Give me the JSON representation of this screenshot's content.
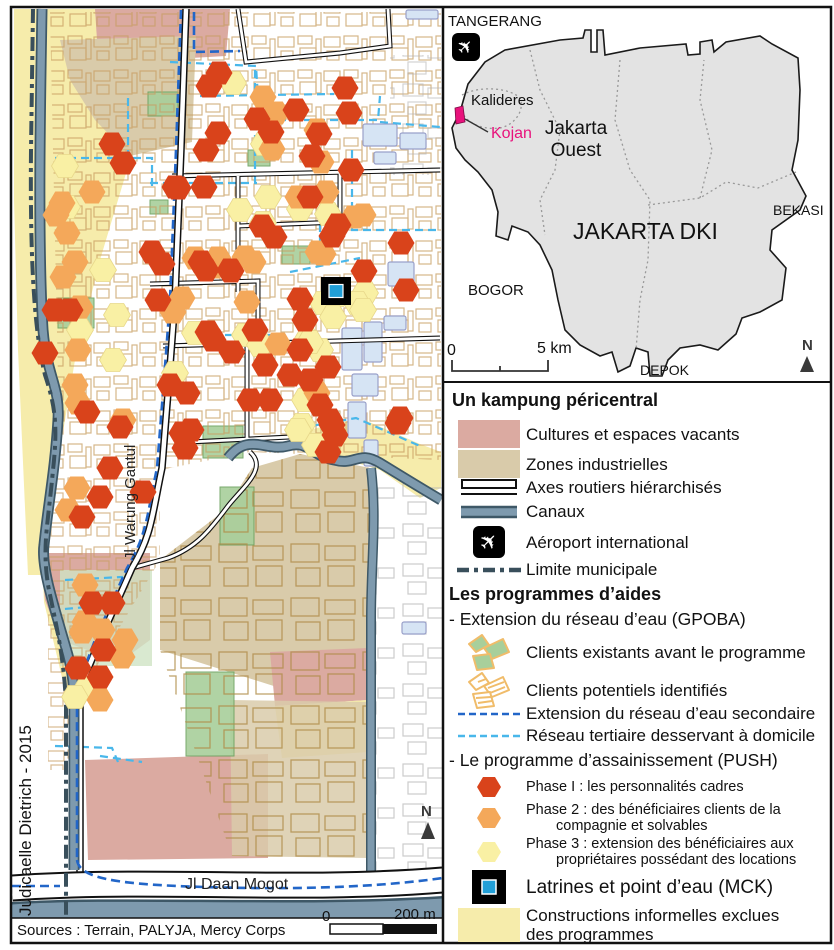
{
  "credit": "Judicaelle Dietrich - 2015",
  "sources": "Sources : Terrain, PALYJA, Mercy Corps",
  "map": {
    "road_label_vertical": "Jl Warung Gantul",
    "road_label_bottom": "Jl Daan Mogot",
    "north_label": "N",
    "scalebar": {
      "zero": "0",
      "end": "200 m"
    },
    "markers": {
      "phase1": [
        [
          219,
          73
        ],
        [
          209,
          86
        ],
        [
          296,
          110
        ],
        [
          218,
          133
        ],
        [
          206,
          150
        ],
        [
          257,
          119
        ],
        [
          271,
          132
        ],
        [
          345,
          88
        ],
        [
          349,
          113
        ],
        [
          319,
          134
        ],
        [
          312,
          156
        ],
        [
          175,
          187
        ],
        [
          204,
          187
        ],
        [
          123,
          163
        ],
        [
          310,
          197
        ],
        [
          262,
          226
        ],
        [
          274,
          237
        ],
        [
          332,
          236
        ],
        [
          338,
          225
        ],
        [
          401,
          243
        ],
        [
          152,
          252
        ],
        [
          201,
          262
        ],
        [
          231,
          271
        ],
        [
          162,
          264
        ],
        [
          300,
          299
        ],
        [
          364,
          271
        ],
        [
          406,
          290
        ],
        [
          351,
          170
        ],
        [
          112,
          144
        ],
        [
          178,
          188
        ],
        [
          55,
          310
        ],
        [
          70,
          310
        ],
        [
          158,
          300
        ],
        [
          120,
          427
        ],
        [
          45,
          353
        ],
        [
          87,
          412
        ],
        [
          143,
          492
        ],
        [
          110,
          468
        ],
        [
          100,
          497
        ],
        [
          82,
          517
        ],
        [
          208,
          332
        ],
        [
          213,
          340
        ],
        [
          170,
          385
        ],
        [
          187,
          393
        ],
        [
          182,
          433
        ],
        [
          185,
          448
        ],
        [
          230,
          270
        ],
        [
          92,
          603
        ],
        [
          112,
          603
        ],
        [
          103,
          650
        ],
        [
          78,
          668
        ],
        [
          100,
          677
        ],
        [
          305,
          320
        ],
        [
          328,
          367
        ],
        [
          332,
          425
        ],
        [
          398,
          423
        ],
        [
          328,
          452
        ],
        [
          191,
          430
        ],
        [
          206,
          270
        ],
        [
          290,
          375
        ],
        [
          310,
          380
        ],
        [
          330,
          420
        ],
        [
          335,
          435
        ],
        [
          320,
          405
        ],
        [
          265,
          365
        ],
        [
          250,
          400
        ],
        [
          270,
          400
        ],
        [
          300,
          350
        ],
        [
          255,
          330
        ],
        [
          232,
          352
        ],
        [
          400,
          418
        ]
      ],
      "phase2": [
        [
          263,
          97
        ],
        [
          276,
          113
        ],
        [
          317,
          130
        ],
        [
          321,
          162
        ],
        [
          272,
          149
        ],
        [
          298,
          197
        ],
        [
          326,
          192
        ],
        [
          354,
          217
        ],
        [
          363,
          215
        ],
        [
          318,
          252
        ],
        [
          245,
          257
        ],
        [
          195,
          258
        ],
        [
          253,
          262
        ],
        [
          247,
          302
        ],
        [
          323,
          254
        ],
        [
          67,
          233
        ],
        [
          75,
          262
        ],
        [
          63,
          277
        ],
        [
          80,
          307
        ],
        [
          182,
          298
        ],
        [
          173,
          312
        ],
        [
          78,
          350
        ],
        [
          75,
          385
        ],
        [
          78,
          403
        ],
        [
          123,
          420
        ],
        [
          68,
          510
        ],
        [
          77,
          488
        ],
        [
          213,
          267
        ],
        [
          218,
          258
        ],
        [
          85,
          585
        ],
        [
          85,
          622
        ],
        [
          82,
          632
        ],
        [
          102,
          630
        ],
        [
          125,
          640
        ],
        [
          122,
          657
        ],
        [
          100,
          700
        ],
        [
          92,
          192
        ],
        [
          62,
          203
        ],
        [
          56,
          215
        ],
        [
          317,
          393
        ],
        [
          278,
          344
        ]
      ],
      "phase3": [
        [
          233,
          83
        ],
        [
          264,
          144
        ],
        [
          268,
          197
        ],
        [
          300,
          209
        ],
        [
          328,
          214
        ],
        [
          263,
          223
        ],
        [
          337,
          295
        ],
        [
          365,
          293
        ],
        [
          103,
          270
        ],
        [
          117,
          315
        ],
        [
          80,
          330
        ],
        [
          113,
          360
        ],
        [
          175,
          373
        ],
        [
          87,
          688
        ],
        [
          75,
          697
        ],
        [
          65,
          166
        ],
        [
          67,
          207
        ],
        [
          323,
          303
        ],
        [
          333,
          317
        ],
        [
          307,
          340
        ],
        [
          320,
          350
        ],
        [
          357,
          303
        ],
        [
          363,
          310
        ],
        [
          302,
          425
        ],
        [
          315,
          445
        ],
        [
          195,
          333
        ],
        [
          240,
          210
        ],
        [
          245,
          335
        ],
        [
          260,
          345
        ],
        [
          305,
          400
        ],
        [
          298,
          430
        ],
        [
          310,
          342
        ]
      ],
      "mck": [
        336,
        291
      ]
    }
  },
  "inset": {
    "labels": {
      "tangerang": "TANGERANG",
      "kalideres": "Kalideres",
      "kojan": "Kojan",
      "jakarta_ouest": "Jakarta Ouest",
      "jakarta_dki": "JAKARTA DKI",
      "bekasi": "BEKASI",
      "bogor": "BOGOR",
      "depok": "DEPOK"
    },
    "scalebar": {
      "zero": "0",
      "end": "5 km"
    },
    "north_label": "N"
  },
  "legend": {
    "section1_title": "Un kampung péricentral",
    "items1": [
      {
        "label": "Cultures et espaces vacants"
      },
      {
        "label": "Zones industrielles"
      },
      {
        "label": "Axes routiers hiérarchisés"
      },
      {
        "label": "Canaux"
      },
      {
        "label": "Aéroport international"
      },
      {
        "label": "Limite municipale"
      }
    ],
    "section2_title": "Les programmes d’aides",
    "gpoba_title": "- Extension du réseau d’eau (GPOBA)",
    "gpoba_items": [
      {
        "label": "Clients existants avant le programme"
      },
      {
        "label": "Clients potentiels identifiés"
      },
      {
        "label": "Extension du réseau d’eau secondaire"
      },
      {
        "label": "Réseau tertiaire desservant à domicile"
      }
    ],
    "push_title": "- Le programme d’assainissement (PUSH)",
    "push_items": [
      {
        "line1": "Phase I : les personnalités cadres",
        "line2": ""
      },
      {
        "line1": "Phase 2 : des bénéficiaires clients de la",
        "line2": "compagnie et solvables"
      },
      {
        "line1": "Phase 3 : extension des bénéficiaires aux",
        "line2": "propriétaires possédant des locations"
      }
    ],
    "mck_label": "Latrines et point d’eau (MCK)",
    "informal_line1": "Constructions informelles exclues",
    "informal_line2": "des programmes"
  },
  "colors": {
    "phase1": "#d9431b",
    "phase2": "#f4a85a",
    "phase3": "#f9f0a4",
    "phase3_edge": "#e8d88b",
    "mck_blue": "#219fd7",
    "zone_pink": "#dbaaa1",
    "zone_tan": "#d9cbaa",
    "zone_yellow": "#f6ecab",
    "canal": "#7e9aae",
    "canal_edge": "#3e5867",
    "limite": "#394f5b",
    "secondary": "#2266c8",
    "tertiary": "#49b7ea",
    "client_green": "#a8cf9b",
    "client_green_edge": "#6aa05e",
    "client_orange": "#f0bc6a",
    "kojan_pink": "#e8127c",
    "inset_gray": "#e3e3e3"
  }
}
